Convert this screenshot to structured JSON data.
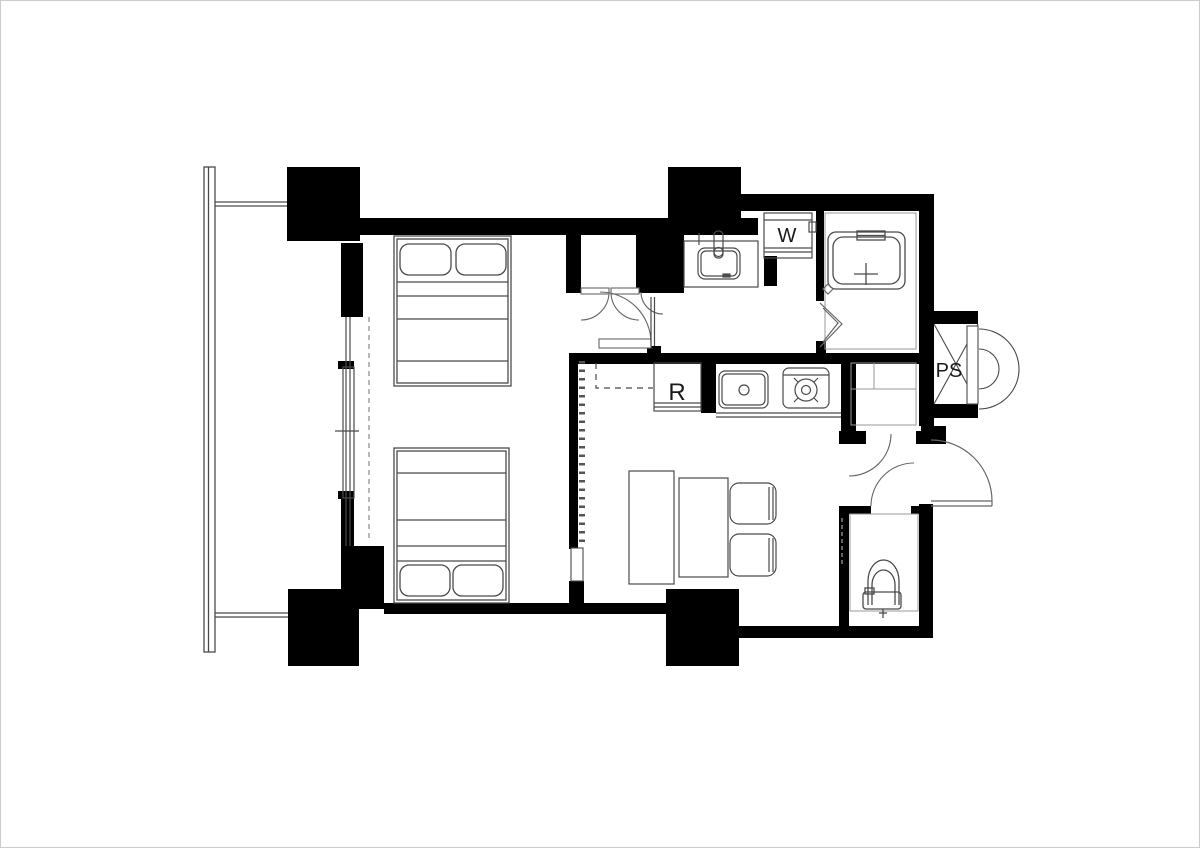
{
  "page": {
    "background": "#ffffff",
    "border_color": "#cccccc"
  },
  "plan": {
    "type": "apartment-floor-plan",
    "labels": {
      "washing_machine": "W",
      "refrigerator": "R",
      "pipe_space": "PS"
    },
    "colors": {
      "wall": "#000000",
      "fixture_line": "#4a4a4a",
      "faint_line": "#999999",
      "door_line": "#666666",
      "floor": "#ffffff",
      "text": "#1a1a1a"
    }
  }
}
